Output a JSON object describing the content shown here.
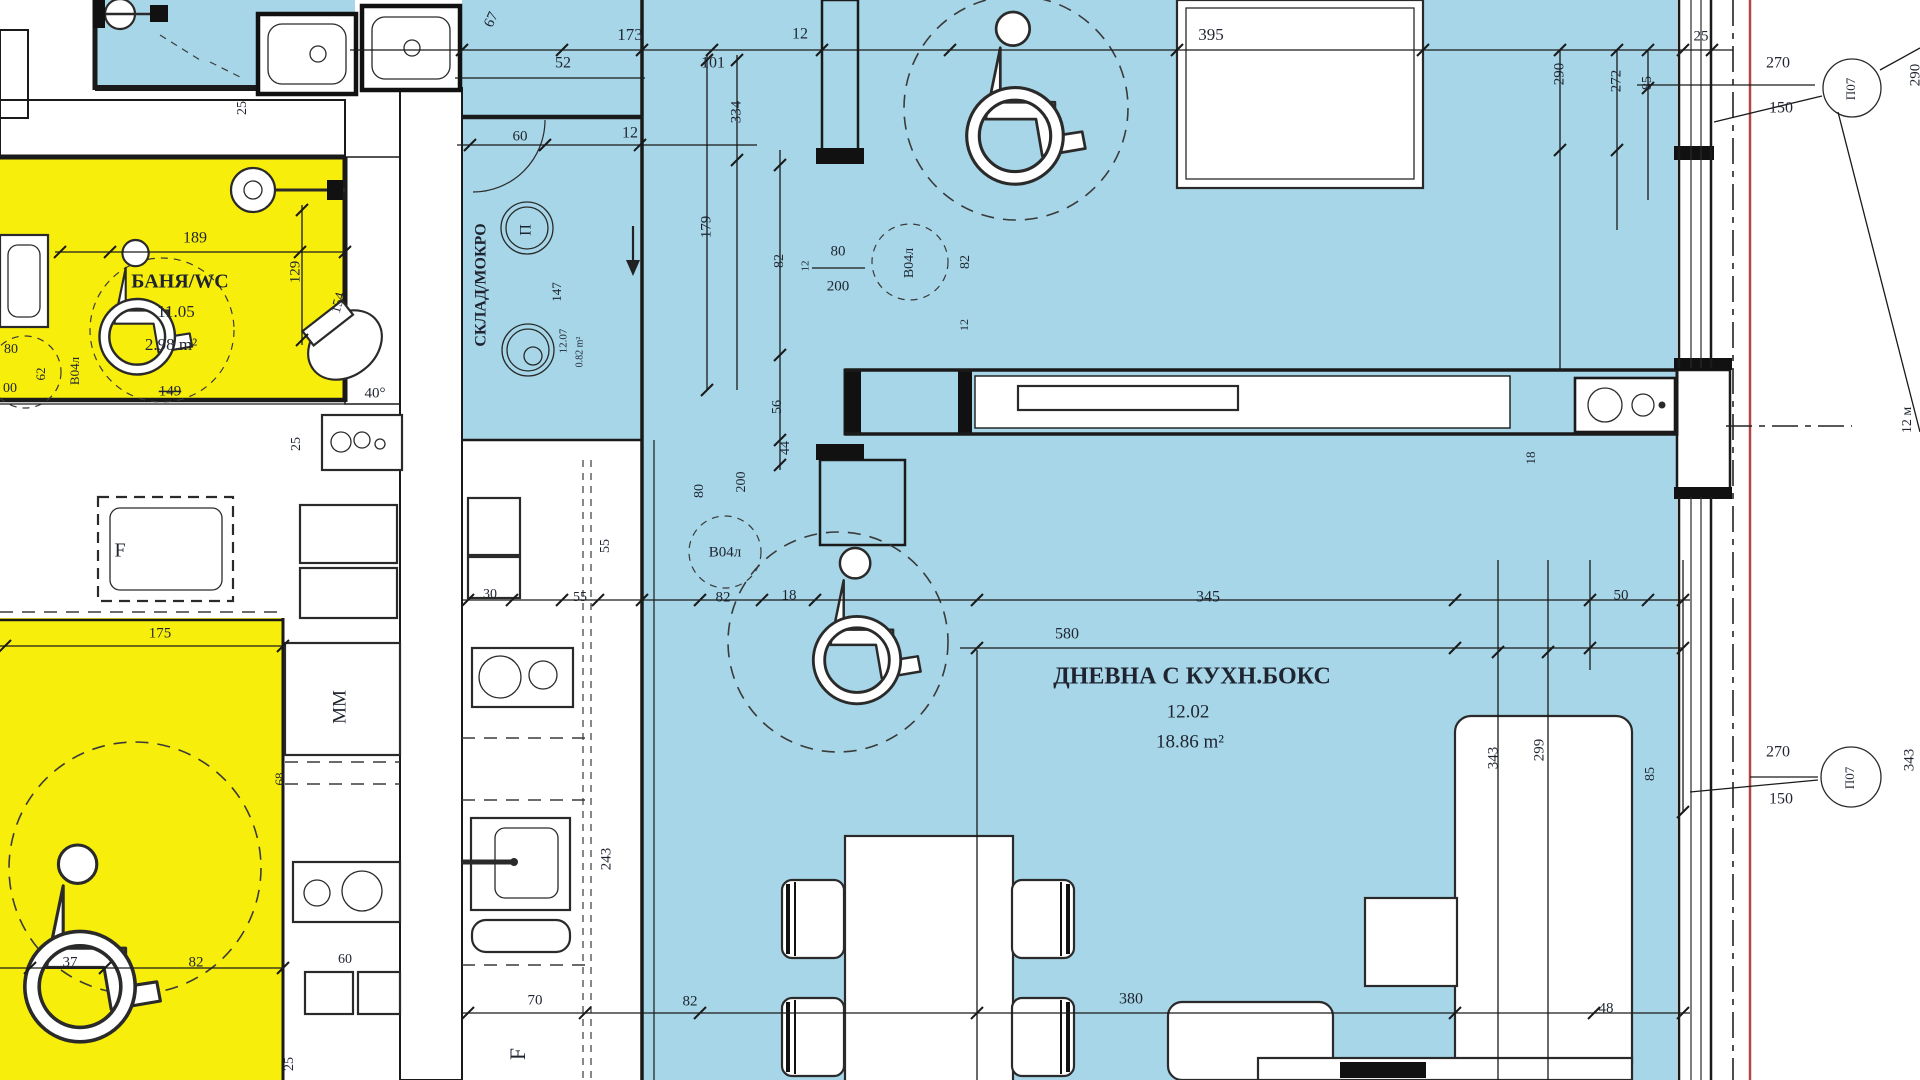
{
  "plan": {
    "rooms": [
      {
        "name": "БАНЯ/WC",
        "number": "11.05",
        "area": "2.98 m²",
        "fill": "#f8ee0b"
      },
      {
        "name": "СКЛАД/МОКРО",
        "number": "12.07",
        "area": "0.82 m²",
        "fill": "#a6d6e7"
      },
      {
        "name": "ДНЕВНА С КУХН.БОКС",
        "number": "12.02",
        "area": "18.86 m²",
        "fill": "#a6d6e7"
      }
    ],
    "door_tags": [
      "В04л",
      "В04л",
      "В04л"
    ],
    "window_tags": [
      "П07",
      "П07"
    ],
    "appliance_labels": [
      "П",
      "F",
      "F",
      "MM"
    ],
    "door_sizes": [
      {
        "width": "80",
        "height": "200"
      },
      {
        "width": "80",
        "height": "200"
      },
      {
        "width": "270",
        "height": "150"
      },
      {
        "width": "270",
        "height": "150"
      }
    ]
  },
  "colors": {
    "room_blue": "#a6d6e7",
    "room_yellow": "#f8ee0b",
    "wall_line": "#1a1a1a",
    "dimension_text": "#1f2430",
    "boundary_red": "#b04848",
    "hatch_line": "#565656"
  },
  "annotations": [
    {
      "n": "dimension-label",
      "t": "67",
      "x": 492,
      "y": 20,
      "r": -65,
      "s": 15
    },
    {
      "n": "dimension-label",
      "t": "173",
      "x": 630,
      "y": 36,
      "s": 17
    },
    {
      "n": "dimension-label",
      "t": "52",
      "x": 563,
      "y": 64,
      "s": 16
    },
    {
      "n": "dimension-label",
      "t": "101",
      "x": 713,
      "y": 64,
      "s": 16
    },
    {
      "n": "dimension-label",
      "t": "12",
      "x": 800,
      "y": 35,
      "s": 16
    },
    {
      "n": "dimension-label",
      "t": "12",
      "x": 630,
      "y": 134,
      "s": 16
    },
    {
      "n": "dimension-label",
      "t": "60",
      "x": 520,
      "y": 137,
      "s": 15
    },
    {
      "n": "dimension-label",
      "t": "334",
      "x": 737,
      "y": 112,
      "r": -90,
      "s": 15
    },
    {
      "n": "dimension-label",
      "t": "179",
      "x": 707,
      "y": 227,
      "r": -90,
      "s": 15
    },
    {
      "n": "dimension-label",
      "t": "82",
      "x": 780,
      "y": 261,
      "r": -90,
      "s": 14
    },
    {
      "n": "door-size-width",
      "t": "80",
      "x": 838,
      "y": 252,
      "s": 15
    },
    {
      "n": "door-size-height",
      "t": "200",
      "x": 838,
      "y": 287,
      "s": 15
    },
    {
      "n": "dimension-label",
      "t": "12",
      "x": 806,
      "y": 266,
      "r": -90,
      "s": 11
    },
    {
      "n": "door-tag",
      "t": "В04л",
      "x": 910,
      "y": 263,
      "r": -90,
      "s": 14
    },
    {
      "n": "dimension-label",
      "t": "82",
      "x": 966,
      "y": 262,
      "r": -90,
      "s": 14
    },
    {
      "n": "dimension-label",
      "t": "395",
      "x": 1211,
      "y": 36,
      "s": 17
    },
    {
      "n": "dimension-label",
      "t": "290",
      "x": 1560,
      "y": 74,
      "r": -90,
      "s": 15
    },
    {
      "n": "dimension-label",
      "t": "272",
      "x": 1617,
      "y": 81,
      "r": -90,
      "s": 15
    },
    {
      "n": "dimension-label",
      "t": "85",
      "x": 1648,
      "y": 83,
      "r": -90,
      "s": 14
    },
    {
      "n": "dimension-label",
      "t": "25",
      "x": 1701,
      "y": 37,
      "s": 15
    },
    {
      "n": "door-size-width",
      "t": "270",
      "x": 1778,
      "y": 64,
      "s": 16
    },
    {
      "n": "door-size-height",
      "t": "150",
      "x": 1781,
      "y": 109,
      "s": 16
    },
    {
      "n": "window-tag",
      "t": "П07",
      "x": 1852,
      "y": 89,
      "r": -90,
      "s": 13
    },
    {
      "n": "dimension-label",
      "t": "290",
      "x": 1916,
      "y": 75,
      "r": -90,
      "s": 15
    },
    {
      "n": "dimension-label",
      "t": "12 м",
      "x": 1908,
      "y": 420,
      "r": -90,
      "s": 14
    },
    {
      "n": "dimension-label",
      "t": "56",
      "x": 778,
      "y": 407,
      "r": -90,
      "s": 14
    },
    {
      "n": "dimension-label",
      "t": "44",
      "x": 786,
      "y": 448,
      "r": -90,
      "s": 14
    },
    {
      "n": "dimension-label",
      "t": "18",
      "x": 1532,
      "y": 458,
      "r": -90,
      "s": 13
    },
    {
      "n": "dimension-label",
      "t": "12",
      "x": 965,
      "y": 325,
      "r": -90,
      "s": 12
    },
    {
      "n": "dimension-label",
      "t": "80",
      "x": 700,
      "y": 491,
      "r": -90,
      "s": 14
    },
    {
      "n": "dimension-label",
      "t": "200",
      "x": 742,
      "y": 482,
      "r": -90,
      "s": 14
    },
    {
      "n": "dimension-label",
      "t": "55",
      "x": 606,
      "y": 546,
      "r": -90,
      "s": 14
    },
    {
      "n": "door-tag",
      "t": "В04л",
      "x": 725,
      "y": 553,
      "s": 15
    },
    {
      "n": "dimension-label",
      "t": "55",
      "x": 580,
      "y": 598,
      "s": 14
    },
    {
      "n": "dimension-label",
      "t": "30",
      "x": 490,
      "y": 595,
      "s": 14
    },
    {
      "n": "dimension-label",
      "t": "82",
      "x": 723,
      "y": 598,
      "s": 15
    },
    {
      "n": "dimension-label",
      "t": "18",
      "x": 789,
      "y": 596,
      "s": 15
    },
    {
      "n": "dimension-label",
      "t": "345",
      "x": 1208,
      "y": 598,
      "s": 16
    },
    {
      "n": "dimension-label",
      "t": "50",
      "x": 1621,
      "y": 596,
      "s": 15
    },
    {
      "n": "dimension-label",
      "t": "580",
      "x": 1067,
      "y": 635,
      "s": 16
    },
    {
      "n": "room-name-label",
      "t": "ДНЕВНА С КУХН.БОКС",
      "x": 1192,
      "y": 678,
      "s": 24,
      "w": 700
    },
    {
      "n": "room-number-label",
      "t": "12.02",
      "x": 1188,
      "y": 713,
      "s": 19
    },
    {
      "n": "room-area-label",
      "t": "18.86 m²",
      "x": 1190,
      "y": 743,
      "s": 19
    },
    {
      "n": "dimension-label",
      "t": "343",
      "x": 1494,
      "y": 758,
      "r": -90,
      "s": 15
    },
    {
      "n": "dimension-label",
      "t": "299",
      "x": 1540,
      "y": 750,
      "r": -90,
      "s": 15
    },
    {
      "n": "dimension-label",
      "t": "85",
      "x": 1651,
      "y": 774,
      "r": -90,
      "s": 14
    },
    {
      "n": "door-size-width",
      "t": "270",
      "x": 1778,
      "y": 753,
      "s": 16
    },
    {
      "n": "door-size-height",
      "t": "150",
      "x": 1781,
      "y": 800,
      "s": 16
    },
    {
      "n": "window-tag",
      "t": "П07",
      "x": 1851,
      "y": 778,
      "r": -90,
      "s": 13
    },
    {
      "n": "dimension-label",
      "t": "343",
      "x": 1910,
      "y": 760,
      "r": -90,
      "s": 15
    },
    {
      "n": "dimension-label",
      "t": "70",
      "x": 535,
      "y": 1001,
      "s": 15
    },
    {
      "n": "dimension-label",
      "t": "82",
      "x": 690,
      "y": 1002,
      "s": 15
    },
    {
      "n": "dimension-label",
      "t": "380",
      "x": 1131,
      "y": 1000,
      "s": 16
    },
    {
      "n": "dimension-label",
      "t": "48",
      "x": 1606,
      "y": 1009,
      "s": 15
    },
    {
      "n": "appliance-label",
      "t": "F",
      "x": 520,
      "y": 1054,
      "r": -90,
      "s": 22
    },
    {
      "n": "dimension-label",
      "t": "189",
      "x": 195,
      "y": 239,
      "s": 16
    },
    {
      "n": "room-name-label",
      "t": "БАНЯ/WC",
      "x": 180,
      "y": 283,
      "s": 20,
      "w": 700
    },
    {
      "n": "room-number-label",
      "t": "11.05",
      "x": 176,
      "y": 313,
      "s": 17
    },
    {
      "n": "room-area-label",
      "t": "2.98 m²",
      "x": 171,
      "y": 346,
      "s": 17
    },
    {
      "n": "dimension-label",
      "t": "129",
      "x": 296,
      "y": 272,
      "r": -90,
      "s": 15
    },
    {
      "n": "dimension-label",
      "t": "154",
      "x": 339,
      "y": 303,
      "r": -75,
      "s": 14
    },
    {
      "n": "dimension-label",
      "t": "149",
      "x": 170,
      "y": 392,
      "s": 15,
      "strike": true
    },
    {
      "n": "angle-label",
      "t": "40°",
      "x": 375,
      "y": 394,
      "s": 15
    },
    {
      "n": "dimension-label",
      "t": "25",
      "x": 297,
      "y": 444,
      "r": -90,
      "s": 14
    },
    {
      "n": "door-size-width",
      "t": "80",
      "x": 11,
      "y": 350,
      "s": 14
    },
    {
      "n": "door-size-height",
      "t": "00",
      "x": 10,
      "y": 389,
      "s": 14
    },
    {
      "n": "dimension-label",
      "t": "62",
      "x": 42,
      "y": 374,
      "r": -90,
      "s": 13
    },
    {
      "n": "door-tag",
      "t": "В04л",
      "x": 76,
      "y": 371,
      "r": -90,
      "s": 13
    },
    {
      "n": "dimension-label",
      "t": "25",
      "x": 243,
      "y": 108,
      "r": -90,
      "s": 14
    },
    {
      "n": "room-name-label",
      "t": "СКЛАД/МОКРО",
      "x": 482,
      "y": 285,
      "r": -90,
      "s": 16,
      "w": 700
    },
    {
      "n": "appliance-label",
      "t": "П",
      "x": 527,
      "y": 230,
      "r": -90,
      "s": 16
    },
    {
      "n": "room-number-label",
      "t": "12.07",
      "x": 564,
      "y": 341,
      "r": -90,
      "s": 11
    },
    {
      "n": "room-area-label",
      "t": "0.82 m²",
      "x": 580,
      "y": 352,
      "r": -90,
      "s": 10
    },
    {
      "n": "dimension-label",
      "t": "147",
      "x": 558,
      "y": 292,
      "r": -90,
      "s": 13
    },
    {
      "n": "dimension-label",
      "t": "175",
      "x": 160,
      "y": 634,
      "s": 15
    },
    {
      "n": "appliance-label",
      "t": "MM",
      "x": 341,
      "y": 707,
      "r": -90,
      "s": 19
    },
    {
      "n": "appliance-label",
      "t": "F",
      "x": 120,
      "y": 552,
      "s": 20
    },
    {
      "n": "dimension-label",
      "t": "68",
      "x": 281,
      "y": 779,
      "r": -90,
      "s": 13
    },
    {
      "n": "dimension-label",
      "t": "37",
      "x": 70,
      "y": 963,
      "s": 15
    },
    {
      "n": "dimension-label",
      "t": "82",
      "x": 196,
      "y": 963,
      "s": 15
    },
    {
      "n": "dimension-label",
      "t": "60",
      "x": 345,
      "y": 960,
      "s": 14
    },
    {
      "n": "dimension-label",
      "t": "25",
      "x": 290,
      "y": 1064,
      "r": -90,
      "s": 14
    },
    {
      "n": "dimension-label",
      "t": "243",
      "x": 607,
      "y": 859,
      "r": -90,
      "s": 15
    }
  ]
}
